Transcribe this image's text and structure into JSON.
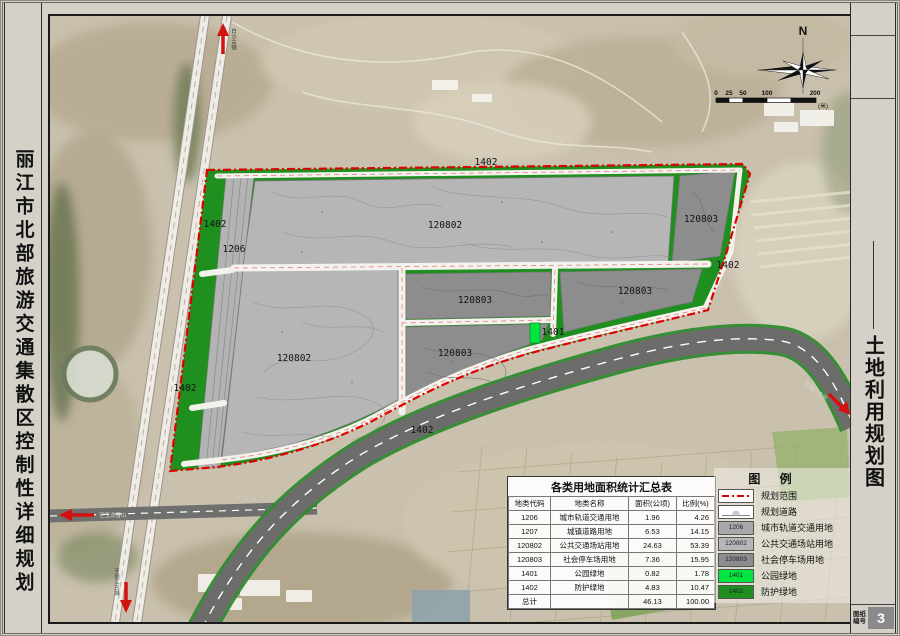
{
  "frame": {
    "left_title": "丽江市北部旅游交通集散区控制性详细规划",
    "right_title": "土地利用规划图",
    "sheet_label_line1": "图纸",
    "sheet_label_line2": "编号",
    "sheet_number": "3"
  },
  "compass": {
    "north_label": "N"
  },
  "scalebar": {
    "ticks": [
      "0",
      "25",
      "50",
      "100",
      "200"
    ],
    "unit": "(米)"
  },
  "map": {
    "labels": {
      "green_top": "1402",
      "green_left_upper": "1402",
      "rail_strip": "1206",
      "transit_upper": "120802",
      "parking_topright": "120803",
      "green_right": "1402",
      "parking_mid": "120803",
      "parking_rightmid": "120803",
      "park": "1401",
      "parking_lowermid": "120803",
      "transit_lower": "120802",
      "green_left_lower": "1402",
      "green_curve": "1402"
    },
    "directions": {
      "north": "白沙古镇",
      "south": "至丽江古城",
      "west": "至玉龙雪山",
      "east": "至丽江市区"
    }
  },
  "table": {
    "title": "各类用地面积统计汇总表",
    "headers": [
      "地类代码",
      "地类名称",
      "面积(公顷)",
      "比例(%)"
    ],
    "rows": [
      {
        "code": "1206",
        "name": "城市轨道交通用地",
        "area": "1.96",
        "pct": "4.26"
      },
      {
        "code": "1207",
        "name": "城镇道路用地",
        "area": "6.53",
        "pct": "14.15"
      },
      {
        "code": "120802",
        "name": "公共交通场站用地",
        "area": "24.63",
        "pct": "53.39"
      },
      {
        "code": "120803",
        "name": "社会停车场用地",
        "area": "7.36",
        "pct": "15.95"
      },
      {
        "code": "1401",
        "name": "公园绿地",
        "area": "0.82",
        "pct": "1.78"
      },
      {
        "code": "1402",
        "name": "防护绿地",
        "area": "4.83",
        "pct": "10.47"
      },
      {
        "code": "总计",
        "name": "",
        "area": "46.13",
        "pct": "100.00"
      }
    ]
  },
  "legend": {
    "title": "图  例",
    "items": [
      {
        "code": "",
        "label": "规划范围"
      },
      {
        "code": "",
        "label": "规划道路"
      },
      {
        "code": "1206",
        "label": "城市轨道交通用地",
        "color": "#a8a8a8"
      },
      {
        "code": "120802",
        "label": "公共交通场站用地",
        "color": "#b6b6b6"
      },
      {
        "code": "120803",
        "label": "社会停车场用地",
        "color": "#8d8d8d"
      },
      {
        "code": "1401",
        "label": "公园绿地",
        "color": "#00e640"
      },
      {
        "code": "1402",
        "label": "防护绿地",
        "color": "#1f8f1f"
      }
    ]
  },
  "colors": {
    "boundary_red": "#e10000",
    "highway_gray": "#6c6c6a",
    "green_1402": "#1f8f1f",
    "green_1401": "#00e640",
    "gray_1206": "#b3b3b3",
    "gray_120802": "#b6b6b6",
    "gray_120803": "#8d8d8d"
  }
}
